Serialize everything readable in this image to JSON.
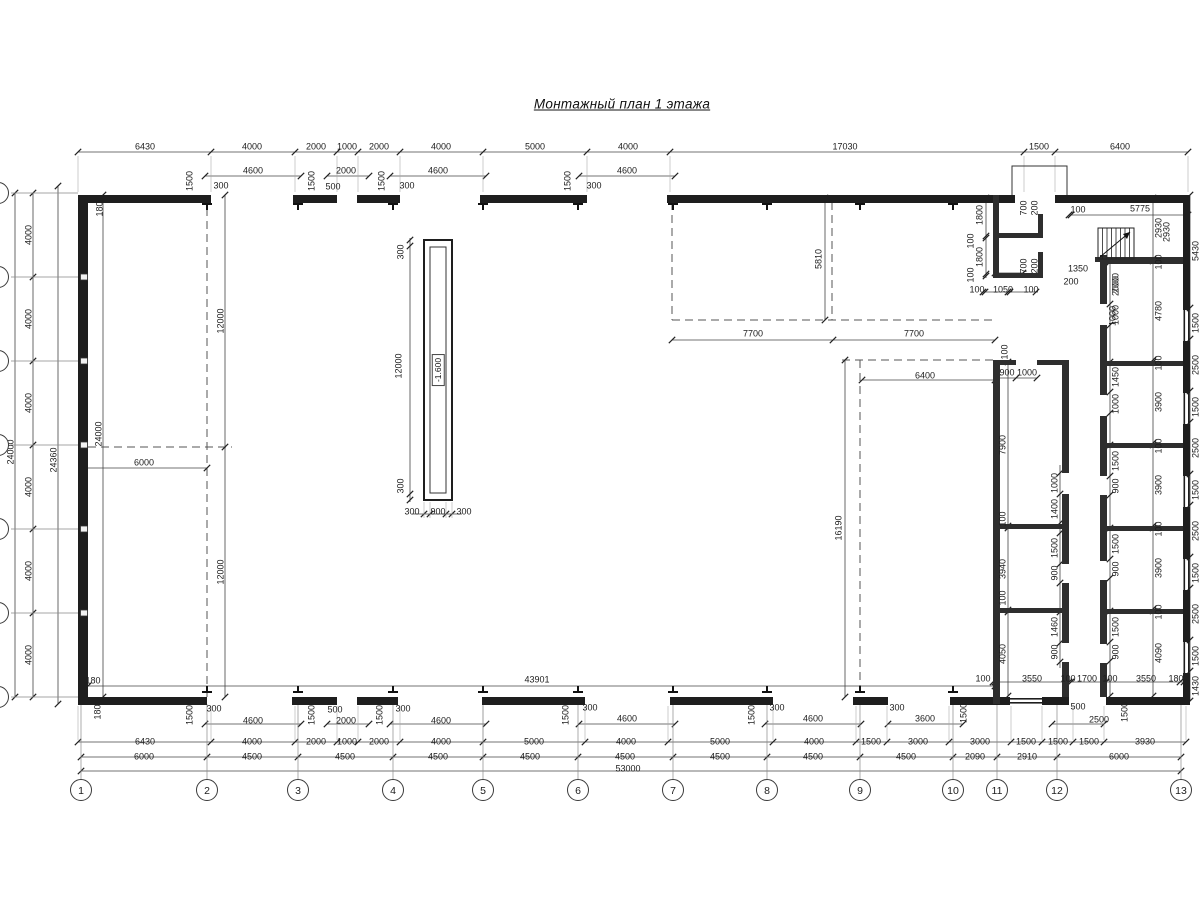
{
  "title": "Монтажный план 1 этажа",
  "pit": {
    "level_label": "-1.600"
  },
  "grid": {
    "bottom_bubbles": [
      {
        "n": "1",
        "x": 81
      },
      {
        "n": "2",
        "x": 207
      },
      {
        "n": "3",
        "x": 298
      },
      {
        "n": "4",
        "x": 393
      },
      {
        "n": "5",
        "x": 483
      },
      {
        "n": "6",
        "x": 578
      },
      {
        "n": "7",
        "x": 673
      },
      {
        "n": "8",
        "x": 767
      },
      {
        "n": "9",
        "x": 860
      },
      {
        "n": "10",
        "x": 953
      },
      {
        "n": "11",
        "x": 997
      },
      {
        "n": "12",
        "x": 1057
      },
      {
        "n": "13",
        "x": 1181
      }
    ],
    "bottom_bubble_y": 790,
    "left_row_ys": [
      193,
      277,
      361,
      445,
      529,
      613,
      697
    ]
  },
  "dims": [
    [
      "6430",
      145,
      147,
      0
    ],
    [
      "4000",
      252,
      147,
      0
    ],
    [
      "2000",
      316,
      147,
      0
    ],
    [
      "1000",
      347,
      147,
      0
    ],
    [
      "2000",
      379,
      147,
      0
    ],
    [
      "4000",
      441,
      147,
      0
    ],
    [
      "5000",
      535,
      147,
      0
    ],
    [
      "4000",
      628,
      147,
      0
    ],
    [
      "17030",
      845,
      147,
      0
    ],
    [
      "1500",
      1039,
      147,
      0
    ],
    [
      "6400",
      1120,
      147,
      0
    ],
    [
      "1500",
      190,
      181,
      1
    ],
    [
      "300",
      221,
      186,
      0
    ],
    [
      "4600",
      253,
      171,
      0
    ],
    [
      "1500",
      312,
      181,
      1
    ],
    [
      "500",
      333,
      187,
      0
    ],
    [
      "2000",
      346,
      171,
      0
    ],
    [
      "1500",
      382,
      181,
      1
    ],
    [
      "300",
      407,
      186,
      0
    ],
    [
      "4600",
      438,
      171,
      0
    ],
    [
      "1500",
      568,
      181,
      1
    ],
    [
      "300",
      594,
      186,
      0
    ],
    [
      "4600",
      627,
      171,
      0
    ],
    [
      "100",
      1078,
      210,
      0
    ],
    [
      "5775",
      1140,
      209,
      0
    ],
    [
      "2930",
      1167,
      232,
      1
    ],
    [
      "1800",
      980,
      215,
      1
    ],
    [
      "100",
      971,
      241,
      1
    ],
    [
      "1800",
      980,
      257,
      1
    ],
    [
      "100",
      971,
      275,
      1
    ],
    [
      "700",
      1024,
      208,
      1
    ],
    [
      "200",
      1035,
      208,
      1
    ],
    [
      "700",
      1024,
      266,
      1
    ],
    [
      "200",
      1035,
      266,
      1
    ],
    [
      "100",
      977,
      290,
      0
    ],
    [
      "1050",
      1003,
      290,
      0
    ],
    [
      "100",
      1031,
      290,
      0
    ],
    [
      "1350",
      1078,
      269,
      0
    ],
    [
      "200",
      1071,
      282,
      0
    ],
    [
      "2000",
      1116,
      286,
      1
    ],
    [
      "1000",
      1113,
      316,
      1
    ],
    [
      "100",
      1005,
      352,
      1
    ],
    [
      "5810",
      819,
      259,
      1
    ],
    [
      "7700",
      753,
      334,
      0
    ],
    [
      "7700",
      914,
      334,
      0
    ],
    [
      "5430",
      1196,
      251,
      1
    ],
    [
      "1500",
      1196,
      323,
      1
    ],
    [
      "2500",
      1196,
      365,
      1
    ],
    [
      "1500",
      1196,
      407,
      1
    ],
    [
      "2500",
      1196,
      448,
      1
    ],
    [
      "1500",
      1196,
      490,
      1
    ],
    [
      "2500",
      1196,
      531,
      1
    ],
    [
      "1500",
      1196,
      573,
      1
    ],
    [
      "2500",
      1196,
      614,
      1
    ],
    [
      "1500",
      1196,
      656,
      1
    ],
    [
      "1430",
      1196,
      686,
      1
    ],
    [
      "2930",
      1159,
      228,
      1
    ],
    [
      "100",
      1159,
      262,
      1
    ],
    [
      "4780",
      1159,
      311,
      1
    ],
    [
      "100",
      1159,
      363,
      1
    ],
    [
      "3900",
      1159,
      402,
      1
    ],
    [
      "100",
      1159,
      446,
      1
    ],
    [
      "3900",
      1159,
      485,
      1
    ],
    [
      "100",
      1159,
      529,
      1
    ],
    [
      "3900",
      1159,
      568,
      1
    ],
    [
      "100",
      1159,
      612,
      1
    ],
    [
      "4090",
      1159,
      653,
      1
    ],
    [
      "2000",
      1116,
      283,
      1
    ],
    [
      "1000",
      1116,
      315,
      1
    ],
    [
      "1450",
      1116,
      377,
      1
    ],
    [
      "1000",
      1116,
      404,
      1
    ],
    [
      "1500",
      1116,
      461,
      1
    ],
    [
      "900",
      1116,
      486,
      1
    ],
    [
      "1500",
      1116,
      544,
      1
    ],
    [
      "900",
      1116,
      569,
      1
    ],
    [
      "1500",
      1116,
      627,
      1
    ],
    [
      "900",
      1116,
      652,
      1
    ],
    [
      "1000",
      1055,
      483,
      1
    ],
    [
      "1400",
      1055,
      509,
      1
    ],
    [
      "1500",
      1055,
      548,
      1
    ],
    [
      "900",
      1055,
      573,
      1
    ],
    [
      "1460",
      1055,
      627,
      1
    ],
    [
      "900",
      1055,
      652,
      1
    ],
    [
      "7900",
      1003,
      445,
      1
    ],
    [
      "100",
      1003,
      519,
      1
    ],
    [
      "3940",
      1003,
      569,
      1
    ],
    [
      "100",
      1003,
      598,
      1
    ],
    [
      "4050",
      1003,
      654,
      1
    ],
    [
      "900",
      1007,
      373,
      0
    ],
    [
      "1000",
      1027,
      373,
      0
    ],
    [
      "6400",
      925,
      376,
      0
    ],
    [
      "16190",
      839,
      528,
      1
    ],
    [
      "4000",
      29,
      235,
      1
    ],
    [
      "4000",
      29,
      319,
      1
    ],
    [
      "4000",
      29,
      403,
      1
    ],
    [
      "4000",
      29,
      487,
      1
    ],
    [
      "4000",
      29,
      571,
      1
    ],
    [
      "4000",
      29,
      655,
      1
    ],
    [
      "24000",
      11,
      452,
      1
    ],
    [
      "24360",
      54,
      460,
      1
    ],
    [
      "24000",
      99,
      434,
      1
    ],
    [
      "12000",
      221,
      321,
      1
    ],
    [
      "12000",
      221,
      572,
      1
    ],
    [
      "6000",
      144,
      463,
      0
    ],
    [
      "180",
      100,
      209,
      1
    ],
    [
      "180",
      93,
      681,
      0
    ],
    [
      "180",
      98,
      712,
      1
    ],
    [
      "43901",
      537,
      680,
      0
    ],
    [
      "300",
      401,
      252,
      1
    ],
    [
      "12000",
      399,
      366,
      1
    ],
    [
      "300",
      401,
      486,
      1
    ],
    [
      "300",
      412,
      512,
      0
    ],
    [
      "900",
      438,
      512,
      0
    ],
    [
      "300",
      464,
      512,
      0
    ],
    [
      "100",
      983,
      679,
      0
    ],
    [
      "3550",
      1032,
      679,
      0
    ],
    [
      "100",
      1068,
      679,
      0
    ],
    [
      "1700",
      1087,
      679,
      0
    ],
    [
      "100",
      1110,
      679,
      0
    ],
    [
      "3550",
      1146,
      679,
      0
    ],
    [
      "180",
      1176,
      679,
      0
    ],
    [
      "1500",
      190,
      715,
      1
    ],
    [
      "300",
      214,
      709,
      0
    ],
    [
      "4600",
      253,
      721,
      0
    ],
    [
      "1500",
      312,
      715,
      1
    ],
    [
      "500",
      335,
      710,
      0
    ],
    [
      "2000",
      346,
      721,
      0
    ],
    [
      "1500",
      380,
      715,
      1
    ],
    [
      "300",
      403,
      709,
      0
    ],
    [
      "4600",
      441,
      721,
      0
    ],
    [
      "1500",
      566,
      715,
      1
    ],
    [
      "300",
      590,
      708,
      0
    ],
    [
      "4600",
      627,
      719,
      0
    ],
    [
      "1500",
      752,
      715,
      1
    ],
    [
      "300",
      777,
      708,
      0
    ],
    [
      "4600",
      813,
      719,
      0
    ],
    [
      "300",
      897,
      708,
      0
    ],
    [
      "3600",
      925,
      719,
      0
    ],
    [
      "1500",
      964,
      713,
      1
    ],
    [
      "500",
      1078,
      707,
      0
    ],
    [
      "2500",
      1099,
      720,
      0
    ],
    [
      "1500",
      1125,
      712,
      1
    ],
    [
      "6430",
      145,
      742,
      0
    ],
    [
      "4000",
      252,
      742,
      0
    ],
    [
      "2000",
      316,
      742,
      0
    ],
    [
      "1000",
      347,
      742,
      0
    ],
    [
      "2000",
      379,
      742,
      0
    ],
    [
      "4000",
      441,
      742,
      0
    ],
    [
      "5000",
      534,
      742,
      0
    ],
    [
      "4000",
      626,
      742,
      0
    ],
    [
      "5000",
      720,
      742,
      0
    ],
    [
      "4000",
      814,
      742,
      0
    ],
    [
      "1500",
      871,
      742,
      0
    ],
    [
      "3000",
      918,
      742,
      0
    ],
    [
      "3000",
      980,
      742,
      0
    ],
    [
      "1500",
      1026,
      742,
      0
    ],
    [
      "1500",
      1058,
      742,
      0
    ],
    [
      "1500",
      1089,
      742,
      0
    ],
    [
      "3930",
      1145,
      742,
      0
    ],
    [
      "6000",
      144,
      757,
      0
    ],
    [
      "4500",
      252,
      757,
      0
    ],
    [
      "4500",
      345,
      757,
      0
    ],
    [
      "4500",
      438,
      757,
      0
    ],
    [
      "4500",
      530,
      757,
      0
    ],
    [
      "4500",
      625,
      757,
      0
    ],
    [
      "4500",
      720,
      757,
      0
    ],
    [
      "4500",
      813,
      757,
      0
    ],
    [
      "4500",
      906,
      757,
      0
    ],
    [
      "2090",
      975,
      757,
      0
    ],
    [
      "2910",
      1027,
      757,
      0
    ],
    [
      "6000",
      1119,
      757,
      0
    ],
    [
      "53000",
      628,
      769,
      0
    ]
  ]
}
